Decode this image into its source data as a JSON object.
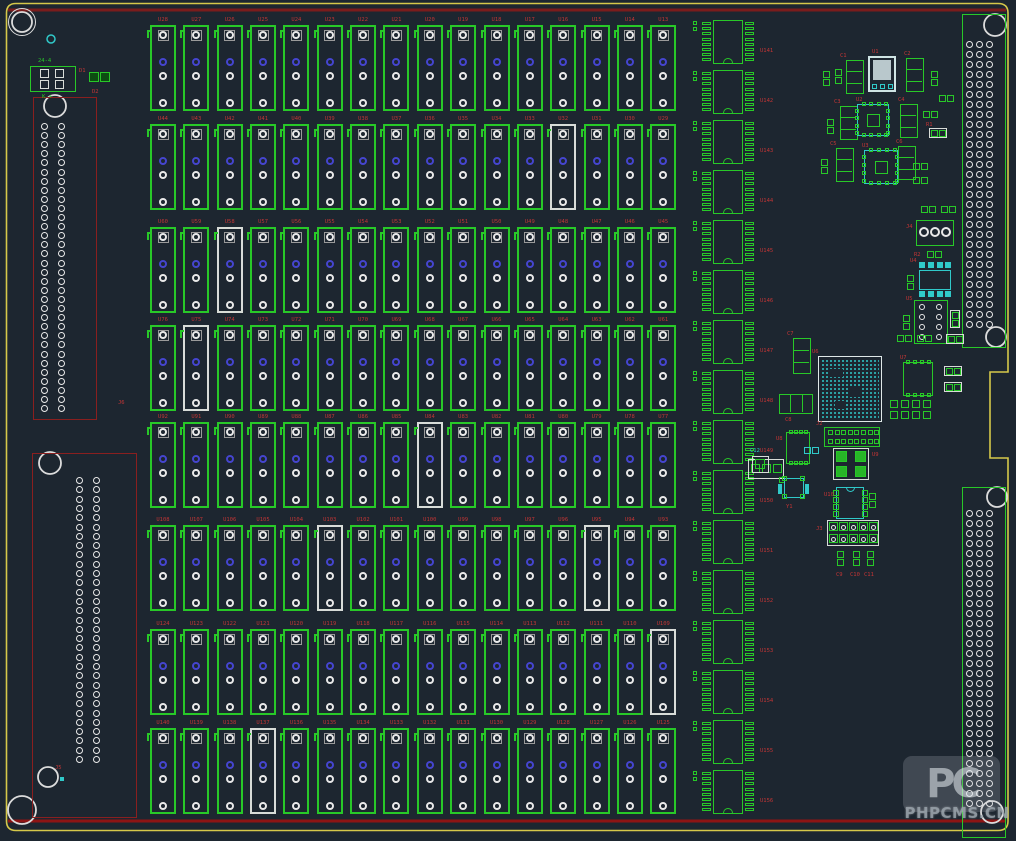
{
  "colors": {
    "bg": "#1d2630",
    "green": "#28c828",
    "dim_green_fill": "#0d4d12",
    "bright_green_fill": "#27b527",
    "white": "#e9e9e9",
    "grey_pad": "#9a9a9a",
    "silk_white": "#d8dcd8",
    "red_label": "#c23535",
    "dark_red": "#8a1f1f",
    "top_line_red": "#7a1c1c",
    "bottom_line_red": "#8e1414",
    "yellow": "#d6c84a",
    "cyan": "#30c9c9",
    "pale_cyan": "#cfe4e4",
    "reg_fill": "#b9c8cc",
    "blue_pad": "#4545cf"
  },
  "relay_grid": {
    "rows": 8,
    "cols": 16,
    "pads_per_footprint": 4,
    "designators": [
      [
        "U28",
        "U27",
        "U26",
        "U25",
        "U24",
        "U23",
        "U22",
        "U21",
        "U20",
        "U19",
        "U18",
        "U17",
        "U16",
        "U15",
        "U14",
        "U13"
      ],
      [
        "U44",
        "U43",
        "U42",
        "U41",
        "U40",
        "U39",
        "U38",
        "U37",
        "U36",
        "U35",
        "U34",
        "U33",
        "U32",
        "U31",
        "U30",
        "U29"
      ],
      [
        "U60",
        "U59",
        "U58",
        "U57",
        "U56",
        "U55",
        "U54",
        "U53",
        "U52",
        "U51",
        "U50",
        "U49",
        "U48",
        "U47",
        "U46",
        "U45"
      ],
      [
        "U76",
        "U75",
        "U74",
        "U73",
        "U72",
        "U71",
        "U70",
        "U69",
        "U68",
        "U67",
        "U66",
        "U65",
        "U64",
        "U63",
        "U62",
        "U61"
      ],
      [
        "U92",
        "U91",
        "U90",
        "U89",
        "U88",
        "U87",
        "U86",
        "U85",
        "U84",
        "U83",
        "U82",
        "U81",
        "U80",
        "U79",
        "U78",
        "U77"
      ],
      [
        "U108",
        "U107",
        "U106",
        "U105",
        "U104",
        "U103",
        "U102",
        "U101",
        "U100",
        "U99",
        "U98",
        "U97",
        "U96",
        "U95",
        "U94",
        "U93"
      ],
      [
        "U124",
        "U123",
        "U122",
        "U121",
        "U120",
        "U119",
        "U118",
        "U117",
        "U116",
        "U115",
        "U114",
        "U113",
        "U112",
        "U111",
        "U110",
        "U109"
      ],
      [
        "U140",
        "U139",
        "U138",
        "U137",
        "U136",
        "U135",
        "U134",
        "U133",
        "U132",
        "U131",
        "U130",
        "U129",
        "U128",
        "U127",
        "U126",
        "U125"
      ]
    ]
  },
  "ic_column": {
    "count": 16,
    "designators": [
      "U141",
      "U142",
      "U143",
      "U144",
      "U145",
      "U146",
      "U147",
      "U148",
      "U149",
      "U150",
      "U151",
      "U152",
      "U153",
      "U154",
      "U155",
      "U156"
    ]
  },
  "connectors": {
    "left_upper": {
      "label": "J6",
      "pad_rows": 32,
      "pad_cols": 2
    },
    "left_lower": {
      "label": "J5",
      "pad_rows": 31,
      "pad_cols": 2
    },
    "right_upper": {
      "pad_rows": 29,
      "pad_cols": 3
    },
    "right_lower": {
      "pad_rows": 30,
      "pad_cols": 3
    }
  },
  "labels": {
    "tl_header": "24-4",
    "tl_footer": "K +",
    "d1": "D1",
    "d2": "D2",
    "u1": "U1",
    "u2": "U2",
    "u3": "U3",
    "u4": "U4",
    "u5": "U5",
    "u6": "U6",
    "u7": "U7",
    "u8": "U8",
    "u9": "U9",
    "u10": "U10",
    "c1": "C1",
    "c2": "C2",
    "c3": "C3",
    "c4": "C4",
    "c5": "C5",
    "c6": "C6",
    "c7": "C7",
    "c8": "C8",
    "c9": "C9",
    "c10": "C10",
    "c11": "C11",
    "c12": "C12",
    "r1": "R1",
    "r2": "R2",
    "y1": "Y1",
    "j2": "J2",
    "j3": "J3",
    "j4": "J4",
    "j5": "J5",
    "j6": "J6"
  },
  "watermark": {
    "logo": "PC",
    "text": "PHPCMS.CN"
  }
}
